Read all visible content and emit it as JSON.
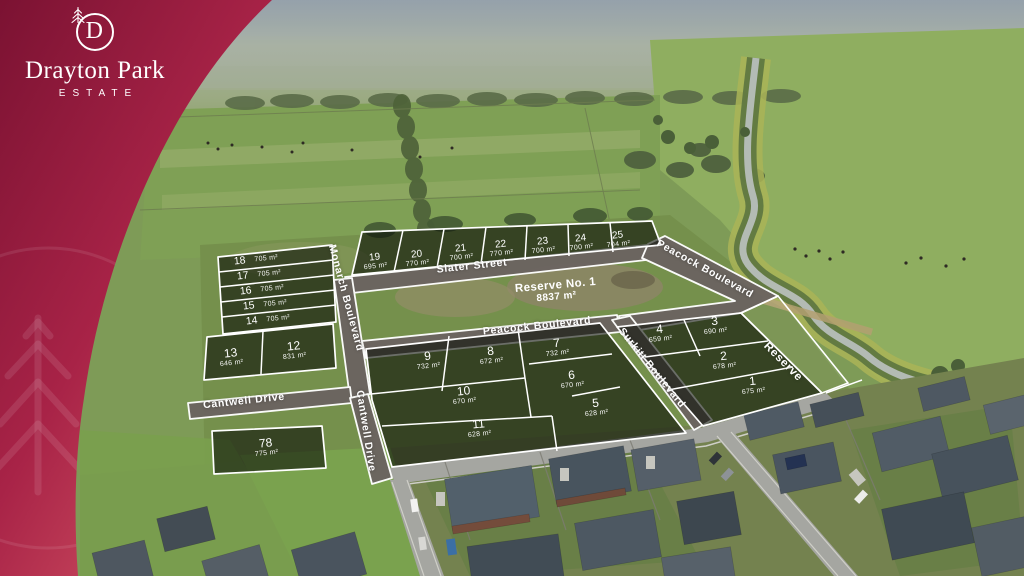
{
  "brand": {
    "monogram": "D",
    "name": "Drayton Park",
    "subtitle": "ESTATE"
  },
  "estate": {
    "reserve_block": {
      "name": "Reserve No. 1",
      "area": "8837 m²"
    },
    "streets": [
      {
        "id": "slater",
        "label": "Slater Street"
      },
      {
        "id": "monarch",
        "label": "Monarch Boulevard"
      },
      {
        "id": "peacock_h",
        "label": "Peacock Boulevard"
      },
      {
        "id": "peacock_d",
        "label": "Peacock Boulevard"
      },
      {
        "id": "surkitt",
        "label": "Surkitt Boulevard"
      },
      {
        "id": "cantwell_h",
        "label": "Cantwell Drive"
      },
      {
        "id": "cantwell_v",
        "label": "Cantwell Drive"
      },
      {
        "id": "reserve_strip",
        "label": "Reserve"
      }
    ],
    "lots": [
      {
        "number": "1",
        "area": "675 m²"
      },
      {
        "number": "2",
        "area": "678 m²"
      },
      {
        "number": "3",
        "area": "690 m²"
      },
      {
        "number": "4",
        "area": "659 m²"
      },
      {
        "number": "5",
        "area": "628 m²"
      },
      {
        "number": "6",
        "area": "670 m²"
      },
      {
        "number": "7",
        "area": "732 m²"
      },
      {
        "number": "8",
        "area": "672 m²"
      },
      {
        "number": "9",
        "area": "732 m²"
      },
      {
        "number": "10",
        "area": "670 m²"
      },
      {
        "number": "11",
        "area": "628 m²"
      },
      {
        "number": "12",
        "area": "831 m²"
      },
      {
        "number": "13",
        "area": "646 m²"
      },
      {
        "number": "14",
        "area": "705 m²"
      },
      {
        "number": "15",
        "area": "705 m²"
      },
      {
        "number": "16",
        "area": "705 m²"
      },
      {
        "number": "17",
        "area": "705 m²"
      },
      {
        "number": "18",
        "area": "705 m²"
      },
      {
        "number": "19",
        "area": "695 m²"
      },
      {
        "number": "20",
        "area": "770 m²"
      },
      {
        "number": "21",
        "area": "700 m²"
      },
      {
        "number": "22",
        "area": "770 m²"
      },
      {
        "number": "23",
        "area": "700 m²"
      },
      {
        "number": "24",
        "area": "700 m²"
      },
      {
        "number": "25",
        "area": "704 m²"
      },
      {
        "number": "78",
        "area": "775 m²"
      }
    ]
  },
  "colors": {
    "brand_dark": "#7b1232",
    "brand_mid": "#a82347",
    "brand_light": "#d95b68",
    "overlay_road": "#6b6460",
    "overlay_line": "#ffffff",
    "lot_fill": "rgba(12,17,8,0.60)"
  }
}
